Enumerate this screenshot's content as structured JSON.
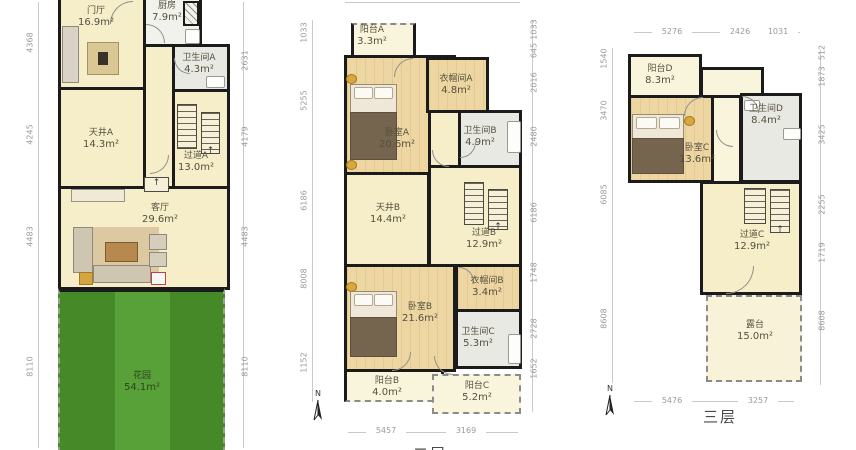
{
  "colors": {
    "wall": "#1b1b1b",
    "room_cream": "#f5eec9",
    "room_wood": "#edd6a2",
    "room_pale": "#f9f5dd",
    "room_gray": "#e9e9e3",
    "garden_green": "#4f9c2e",
    "dim_text": "#9a9a9a"
  },
  "floor1": {
    "rooms": {
      "foyer": {
        "name": "门厅",
        "area": "16.9m²"
      },
      "kitchen": {
        "name": "厨房",
        "area": "7.9m²"
      },
      "bath_a": {
        "name": "卫生间A",
        "area": "4.3m²"
      },
      "court_a": {
        "name": "天井A",
        "area": "14.3m²"
      },
      "hall_a": {
        "name": "过道A",
        "area": "13.0m²"
      },
      "living": {
        "name": "客厅",
        "area": "29.6m²"
      },
      "garden": {
        "name": "花园",
        "area": "54.1m²"
      }
    },
    "dims_left": [
      "4368",
      "4245",
      "4483",
      "8110"
    ],
    "dims_right": [
      "2631",
      "4179",
      "4483",
      "8110"
    ]
  },
  "floor2": {
    "label": "二层",
    "north": "N",
    "rooms": {
      "balcony_a": {
        "name": "阳台A",
        "area": "3.3m²"
      },
      "bed_a": {
        "name": "卧室A",
        "area": "20.6m²"
      },
      "closet_a": {
        "name": "衣帽间A",
        "area": "4.8m²"
      },
      "bath_b": {
        "name": "卫生间B",
        "area": "4.9m²"
      },
      "court_b": {
        "name": "天井B",
        "area": "14.4m²"
      },
      "hall_b": {
        "name": "过道B",
        "area": "12.9m²"
      },
      "closet_b": {
        "name": "衣帽间B",
        "area": "3.4m²"
      },
      "bed_b": {
        "name": "卧室B",
        "area": "21.6m²"
      },
      "bath_c": {
        "name": "卫生间C",
        "area": "5.3m²"
      },
      "balcony_b": {
        "name": "阳台B",
        "area": "4.0m²"
      },
      "balcony_c": {
        "name": "阳台C",
        "area": "5.2m²"
      }
    },
    "dims_left": [
      "1033",
      "5255",
      "6186",
      "8008",
      "1152"
    ],
    "dims_right": [
      "1033",
      "645",
      "2016",
      "2480",
      "6186",
      "1748",
      "2728",
      "1652"
    ],
    "dims_bottom": [
      "5457",
      "3169"
    ]
  },
  "floor3": {
    "label": "三层",
    "north": "N",
    "rooms": {
      "balcony_d": {
        "name": "阳台D",
        "area": "8.3m²"
      },
      "bed_c": {
        "name": "卧室C",
        "area": "13.6m²"
      },
      "bath_d": {
        "name": "卫生间D",
        "area": "8.4m²"
      },
      "hall_c": {
        "name": "过道C",
        "area": "12.9m²"
      },
      "terrace": {
        "name": "露台",
        "area": "15.0m²"
      }
    },
    "dims_top": [
      "5276",
      "2426",
      "1031"
    ],
    "dims_bottom": [
      "5476",
      "3257"
    ],
    "dims_left": [
      "1540",
      "3470",
      "6085",
      "8608"
    ],
    "dims_right": [
      "512",
      "1873",
      "3425",
      "2255",
      "1719",
      "8608"
    ]
  }
}
